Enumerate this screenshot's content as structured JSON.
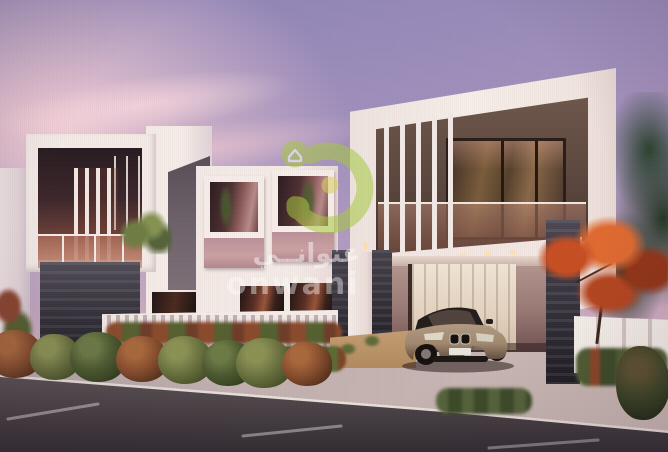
{
  "meta": {
    "description": "Sunset 3D rendering of modern white villas with dark stone pillars, vertical louvres, glass balconies, trimmed hedges, white fences and a bronze SUV parked under a carport beside an asphalt road"
  },
  "watermark": {
    "logo": "house-in-circle-swoosh-logo",
    "arabic_text": "عنوانــي",
    "latin_text": "onwani"
  },
  "palette": {
    "sky-top": "#8d83b6",
    "sky-mid": "#b49dc2",
    "sky-horizon": "#eec7c3",
    "cloud": "#f2ccd4",
    "wall-white": "#f4ebe7",
    "wall-grey": "#6f636c",
    "stone": "#34313a",
    "stone-light": "#514c57",
    "interior": "#281c20",
    "glass-mauve": "#bb9198",
    "logo-green": "#a7ca40",
    "logo-yellow": "#dbd05a",
    "hedge-olive": "#6d7440",
    "hedge-red": "#8a4f2e",
    "hedge-green": "#4c5a30",
    "tree-red": "#c84e22",
    "tree-red-dark": "#933517",
    "tree-green-dark": "#223623",
    "road": "#4c4449",
    "walk": "#c3b4b3",
    "drive": "#c2afac",
    "curb": "#ece3df",
    "sand": "#c49d72",
    "car-body": "#a1886f",
    "dash-line": "#d8d2d6"
  }
}
